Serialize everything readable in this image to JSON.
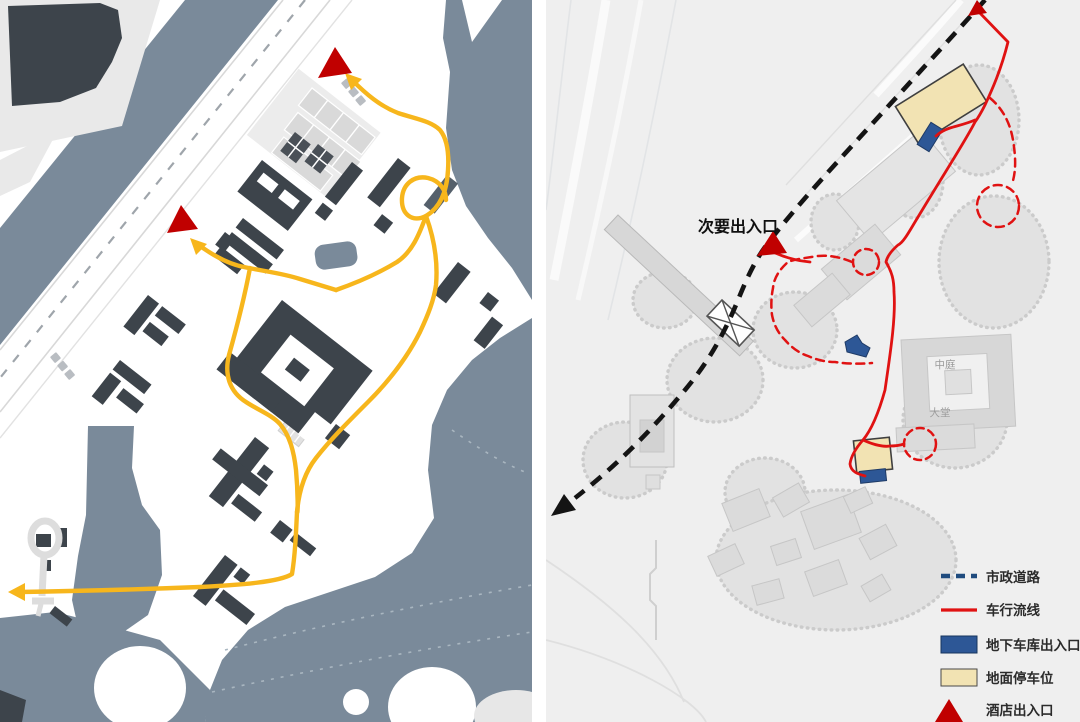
{
  "document": {
    "type": "architectural-site-analysis-diagram",
    "panels": [
      "vehicle-circulation-plan-left",
      "vehicle-circulation-plan-right"
    ]
  },
  "right_map": {
    "labels": {
      "secondary_entrance": "次要出入口",
      "atrium": "中庭",
      "lobby": "大堂"
    },
    "markers": {
      "hotel_entrance_top": "red-triangle",
      "secondary_entrance": "red-triangle"
    }
  },
  "left_map": {
    "markers": {
      "entrance_top": "red-triangle",
      "entrance_mid": "red-triangle"
    },
    "routes": "yellow-vehicle-paths-with-arrows"
  },
  "legend": {
    "items": [
      {
        "label": "市政道路",
        "type": "dashed-navy-line"
      },
      {
        "label": "车行流线",
        "type": "solid-red-line"
      },
      {
        "label": "地下车库出入口",
        "type": "blue-rect"
      },
      {
        "label": "地面停车位",
        "type": "beige-rect"
      },
      {
        "label": "酒店出入口",
        "type": "red-triangle"
      }
    ]
  },
  "colors": {
    "water": "#7A8A9A",
    "building_dark": "#3D444B",
    "route_yellow": "#F7B61C",
    "route_red": "#E01212",
    "municipal_road": "#141414",
    "legend_navy": "#1F4B7E",
    "garage_blue": "#2D5796",
    "parking_beige": "#F2E3B3",
    "marker_red": "#C00000",
    "site_gray": "#EFEFEF"
  }
}
